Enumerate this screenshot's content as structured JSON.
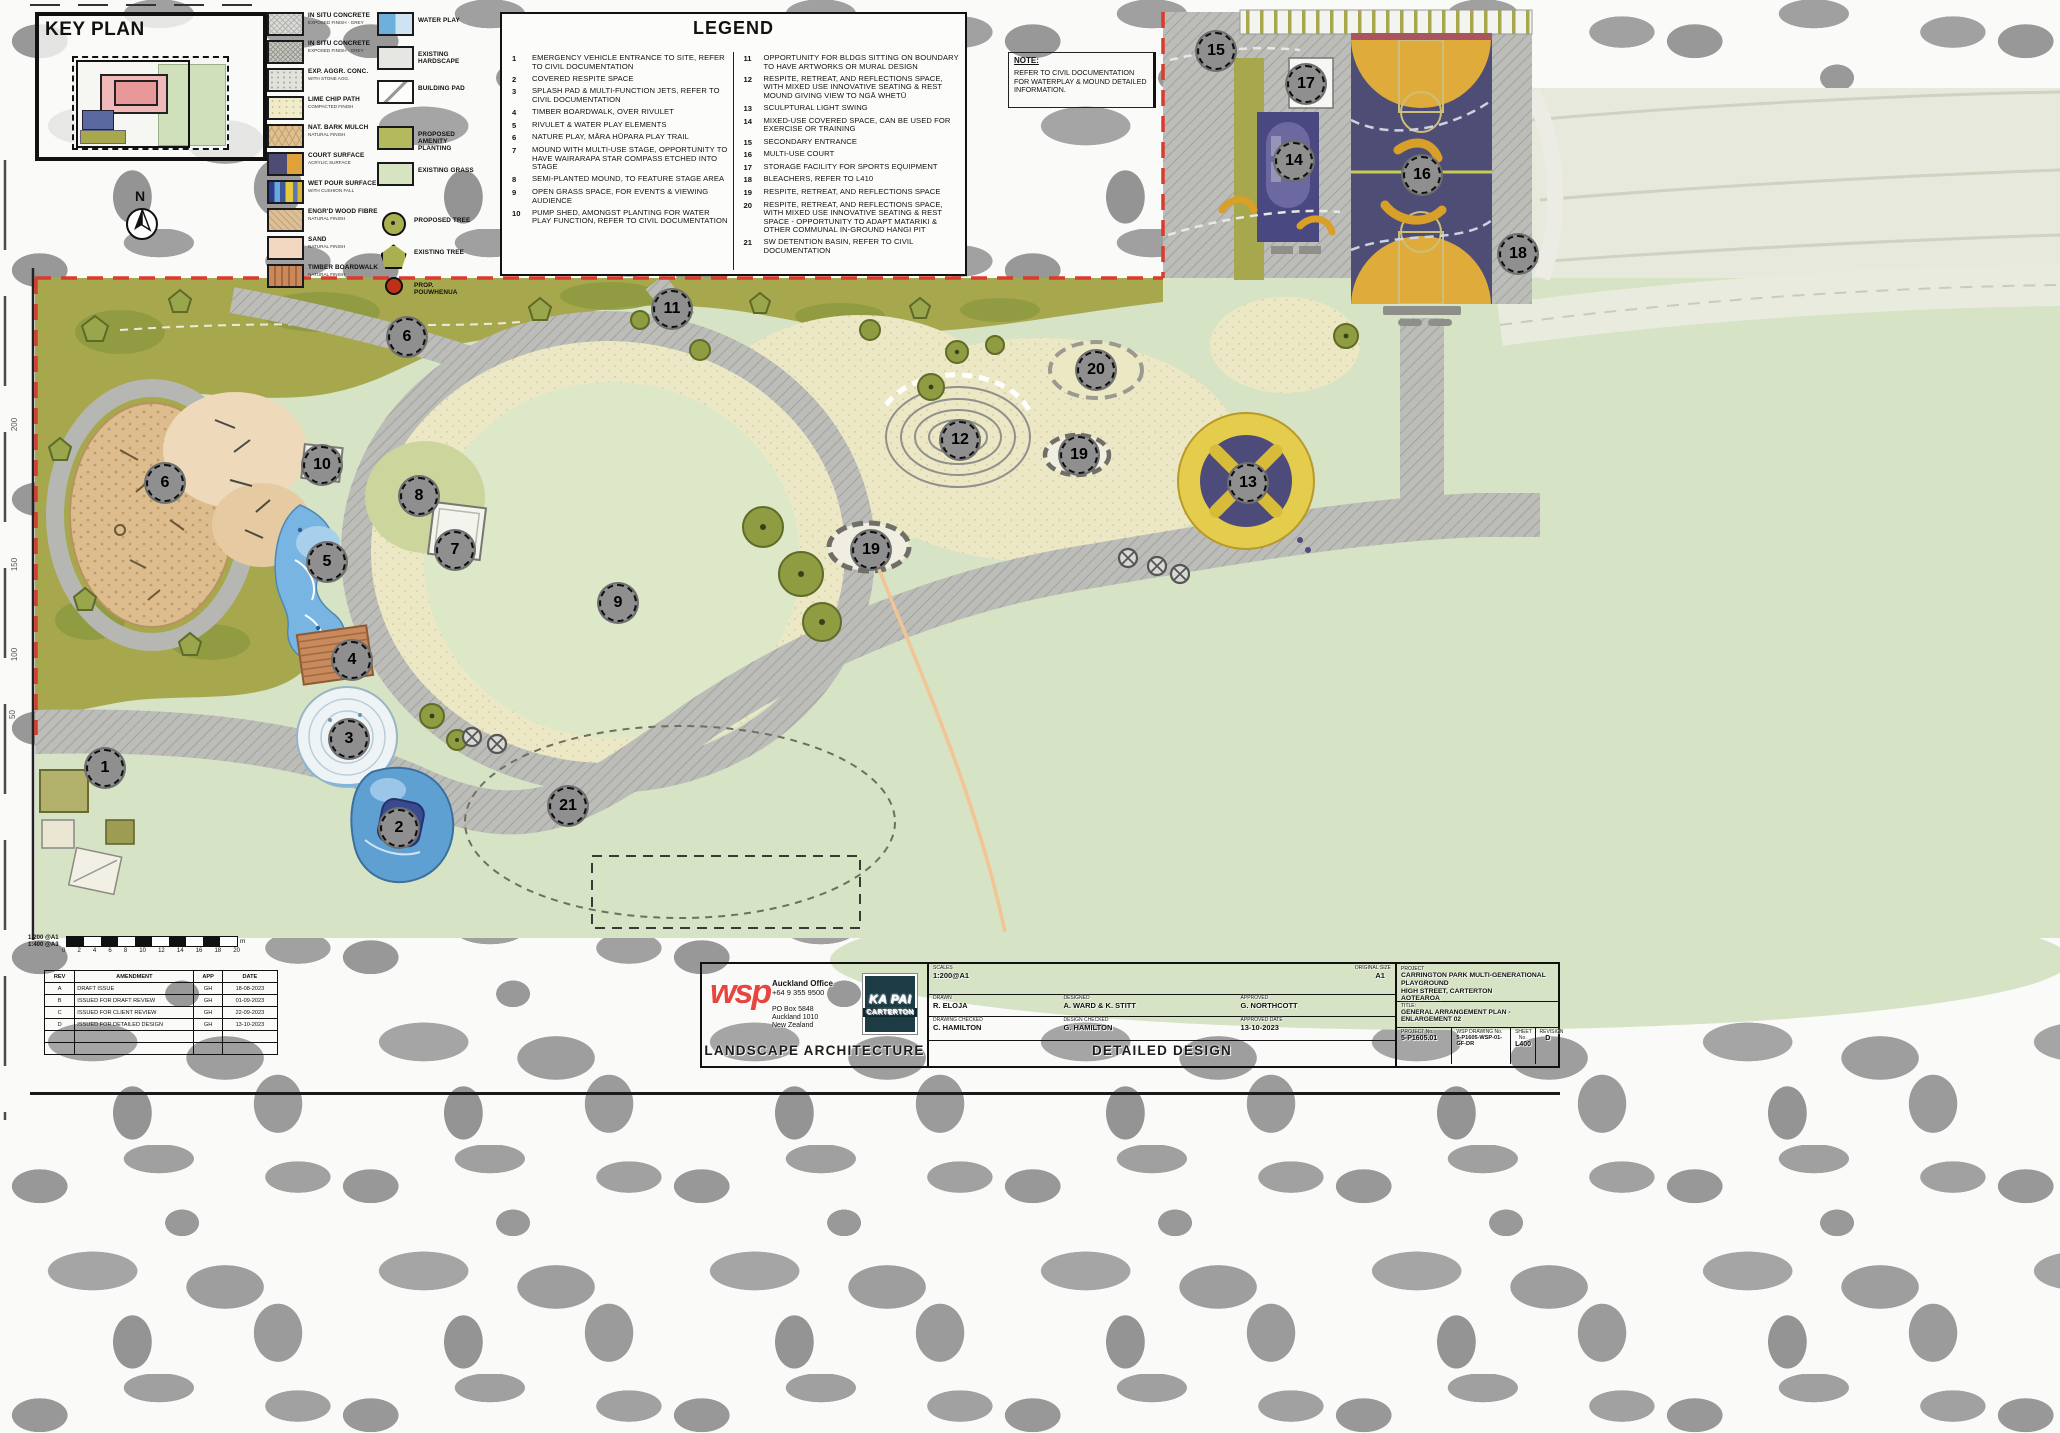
{
  "sheet": {
    "key_plan_title": "KEY PLAN",
    "legend_title": "LEGEND",
    "north_letter": "N",
    "note": {
      "label": "NOTE:",
      "text": "REFER TO CIVIL DOCUMENTATION FOR WATERPLAY & MOUND DETAILED INFORMATION."
    }
  },
  "materials_left": [
    {
      "name": "IN SITU CONCRETE",
      "sub": "EXPOSED FINISH - GREY",
      "swatch": "concrete1"
    },
    {
      "name": "IN SITU CONCRETE",
      "sub": "EXPOSED FINISH - GREY",
      "swatch": "concrete2"
    },
    {
      "name": "EXP. AGGR. CONC.",
      "sub": "WITH STONE AGG.",
      "swatch": "aggr"
    },
    {
      "name": "LIME CHIP PATH",
      "sub": "COMPACTED FINISH",
      "swatch": "lime"
    },
    {
      "name": "NAT. BARK MULCH",
      "sub": "NATURAL FINISH",
      "swatch": "bark"
    },
    {
      "name": "COURT SURFACE",
      "sub": "ACRYLIC SURFACE",
      "swatch": "court"
    },
    {
      "name": "WET POUR SURFACE",
      "sub": "WITH CUSHION FALL",
      "swatch": "wetpour"
    },
    {
      "name": "ENGR'D WOOD FIBRE",
      "sub": "NATURAL FINISH",
      "swatch": "engwood"
    },
    {
      "name": "SAND",
      "sub": "NATURAL FINISH",
      "swatch": "sand"
    },
    {
      "name": "TIMBER BOARDWALK",
      "sub": "NATURAL FINISH",
      "swatch": "timber"
    }
  ],
  "materials_right": [
    {
      "name": "WATER PLAY",
      "kind": "water"
    },
    {
      "name": "EXISTING HARDSCAPE",
      "kind": "hardscape"
    },
    {
      "name": "BUILDING PAD",
      "kind": "pad"
    },
    {
      "name": "PROPOSED AMENITY PLANTING",
      "kind": "planting"
    },
    {
      "name": "EXISTING GRASS",
      "kind": "grass"
    },
    {
      "name": "PROPOSED TREE",
      "kind": "tree"
    },
    {
      "name": "EXISTING TREE",
      "kind": "pent"
    },
    {
      "name": "PROP. POUWHENUA",
      "kind": "dot"
    }
  ],
  "legend": {
    "left": [
      {
        "no": "1",
        "text": "EMERGENCY VEHICLE ENTRANCE TO SITE, REFER TO CIVIL DOCUMENTATION"
      },
      {
        "no": "2",
        "text": "COVERED RESPITE SPACE"
      },
      {
        "no": "3",
        "text": "SPLASH PAD & MULTI-FUNCTION JETS, REFER TO CIVIL DOCUMENTATION"
      },
      {
        "no": "4",
        "text": "TIMBER BOARDWALK, OVER RIVULET"
      },
      {
        "no": "5",
        "text": "RIVULET & WATER PLAY ELEMENTS"
      },
      {
        "no": "6",
        "text": "NATURE PLAY, MĀRA HŪPARA PLAY TRAIL"
      },
      {
        "no": "7",
        "text": "MOUND WITH MULTI-USE STAGE, OPPORTUNITY TO HAVE WAIRARAPA STAR COMPASS ETCHED INTO STAGE"
      },
      {
        "no": "8",
        "text": "SEMI-PLANTED MOUND, TO FEATURE STAGE AREA"
      },
      {
        "no": "9",
        "text": "OPEN GRASS SPACE, FOR EVENTS & VIEWING AUDIENCE"
      },
      {
        "no": "10",
        "text": "PUMP SHED, AMONGST PLANTING FOR WATER PLAY FUNCTION, REFER TO CIVIL DOCUMENTATION"
      }
    ],
    "right": [
      {
        "no": "11",
        "text": "OPPORTUNITY FOR BLDGS SITTING ON BOUNDARY TO HAVE ARTWORKS OR MURAL DESIGN"
      },
      {
        "no": "12",
        "text": "RESPITE, RETREAT, AND REFLECTIONS SPACE, WITH MIXED USE INNOVATIVE SEATING & REST MOUND GIVING VIEW TO NGĀ WHETŪ"
      },
      {
        "no": "13",
        "text": "SCULPTURAL LIGHT SWING"
      },
      {
        "no": "14",
        "text": "MIXED-USE COVERED SPACE, CAN BE USED FOR EXERCISE OR TRAINING"
      },
      {
        "no": "15",
        "text": "SECONDARY ENTRANCE"
      },
      {
        "no": "16",
        "text": "MULTI-USE COURT"
      },
      {
        "no": "17",
        "text": "STORAGE FACILITY FOR SPORTS EQUIPMENT"
      },
      {
        "no": "18",
        "text": "BLEACHERS, REFER TO L410"
      },
      {
        "no": "19",
        "text": "RESPITE, RETREAT, AND REFLECTIONS SPACE"
      },
      {
        "no": "20",
        "text": "RESPITE, RETREAT, AND REFLECTIONS SPACE, WITH MIXED USE INNOVATIVE SEATING & REST SPACE - OPPORTUNITY TO ADAPT MATARIKI & OTHER COMMUNAL IN-GROUND HANGI PIT"
      },
      {
        "no": "21",
        "text": "SW DETENTION BASIN, REFER TO CIVIL DOCUMENTATION"
      }
    ]
  },
  "markers": [
    {
      "no": "1",
      "x": 103,
      "y": 766
    },
    {
      "no": "2",
      "x": 397,
      "y": 826
    },
    {
      "no": "3",
      "x": 347,
      "y": 737
    },
    {
      "no": "4",
      "x": 350,
      "y": 658
    },
    {
      "no": "5",
      "x": 325,
      "y": 560
    },
    {
      "no": "6",
      "x": 405,
      "y": 335
    },
    {
      "no": "6",
      "x": 163,
      "y": 481
    },
    {
      "no": "7",
      "x": 453,
      "y": 548
    },
    {
      "no": "8",
      "x": 417,
      "y": 494
    },
    {
      "no": "9",
      "x": 616,
      "y": 601
    },
    {
      "no": "10",
      "x": 320,
      "y": 463
    },
    {
      "no": "11",
      "x": 670,
      "y": 307
    },
    {
      "no": "12",
      "x": 958,
      "y": 438
    },
    {
      "no": "13",
      "x": 1246,
      "y": 481
    },
    {
      "no": "14",
      "x": 1292,
      "y": 159
    },
    {
      "no": "15",
      "x": 1214,
      "y": 49
    },
    {
      "no": "16",
      "x": 1420,
      "y": 173
    },
    {
      "no": "17",
      "x": 1304,
      "y": 82
    },
    {
      "no": "18",
      "x": 1516,
      "y": 252
    },
    {
      "no": "19",
      "x": 869,
      "y": 548
    },
    {
      "no": "19",
      "x": 1077,
      "y": 453
    },
    {
      "no": "20",
      "x": 1094,
      "y": 368
    },
    {
      "no": "21",
      "x": 566,
      "y": 804
    }
  ],
  "scale_bar": {
    "scales": [
      "1:200 @A1",
      "1:400 @A3"
    ],
    "numbers": [
      "0",
      "2",
      "4",
      "6",
      "8",
      "10",
      "12",
      "14",
      "16",
      "18",
      "20"
    ],
    "unit": "m"
  },
  "revision_table": {
    "headers": [
      "REV",
      "AMENDMENT",
      "APP",
      "DATE"
    ],
    "rows": [
      [
        "A",
        "DRAFT ISSUE",
        "GH",
        "18-08-2023"
      ],
      [
        "B",
        "ISSUED FOR DRAFT REVIEW",
        "GH",
        "01-09-2023"
      ],
      [
        "C",
        "ISSUED FOR CLIENT REVIEW",
        "GH",
        "22-09-2023"
      ],
      [
        "D",
        "ISSUED FOR DETAILED DESIGN",
        "GH",
        "13-10-2023"
      ]
    ]
  },
  "chainage": [
    "200",
    "150",
    "100",
    "50"
  ],
  "title_block": {
    "wsp_logo": "wsp",
    "office": "Auckland Office",
    "phone": "+64 9 355 9500",
    "address": [
      "PO Box 5848",
      "Auckland 1010",
      "New Zealand"
    ],
    "client_logo_line1": "KA PAI",
    "client_logo_line2": "CARTERTON",
    "discipline": "LANDSCAPE ARCHITECTURE",
    "stage": "DETAILED DESIGN",
    "scales_label": "SCALES",
    "scales": "1:200@A1",
    "size_label": "ORIGINAL SIZE",
    "size": "A1",
    "drawn_label": "DRAWN",
    "drawn": "R. ELOJA",
    "designed_label": "DESIGNED",
    "designed": "A. WARD & K. STITT",
    "approved_label": "APPROVED",
    "approved": "G. NORTHCOTT",
    "drawing_checked_label": "DRAWING CHECKED",
    "drawing_checked": "C. HAMILTON",
    "design_checked_label": "DESIGN CHECKED",
    "design_checked": "G. HAMILTON",
    "approved_date_label": "APPROVED DATE",
    "approved_date": "13-10-2023",
    "project_label": "PROJECT",
    "project_line1": "CARRINGTON PARK MULTI-GENERATIONAL PLAYGROUND",
    "project_line2": "HIGH STREET, CARTERTON",
    "project_line3": "AOTEAROA",
    "title_label": "TITLE:",
    "title": "GENERAL ARRANGEMENT PLAN - ENLARGEMENT 02",
    "project_no_label": "PROJECT No.",
    "project_no": "5-P1605.01",
    "drawing_no_label": "WSP DRAWING No.",
    "drawing_no": "5-P1605-WSP-01-GF-DR",
    "sheet_no_label": "SHEET No.",
    "sheet_no": "L400",
    "revision_label": "REVISION",
    "revision": "D"
  },
  "colors": {
    "boundary_red": "#d93b2c",
    "grass": "#d6e3c4",
    "planting_olive": "#a7a84d",
    "lime_chip": "#ece8c6",
    "concrete_gray": "#bcbcb8",
    "court_navy": "#4e4d76",
    "court_yellow": "#dfab3a",
    "wsp_red": "#e8453e"
  }
}
